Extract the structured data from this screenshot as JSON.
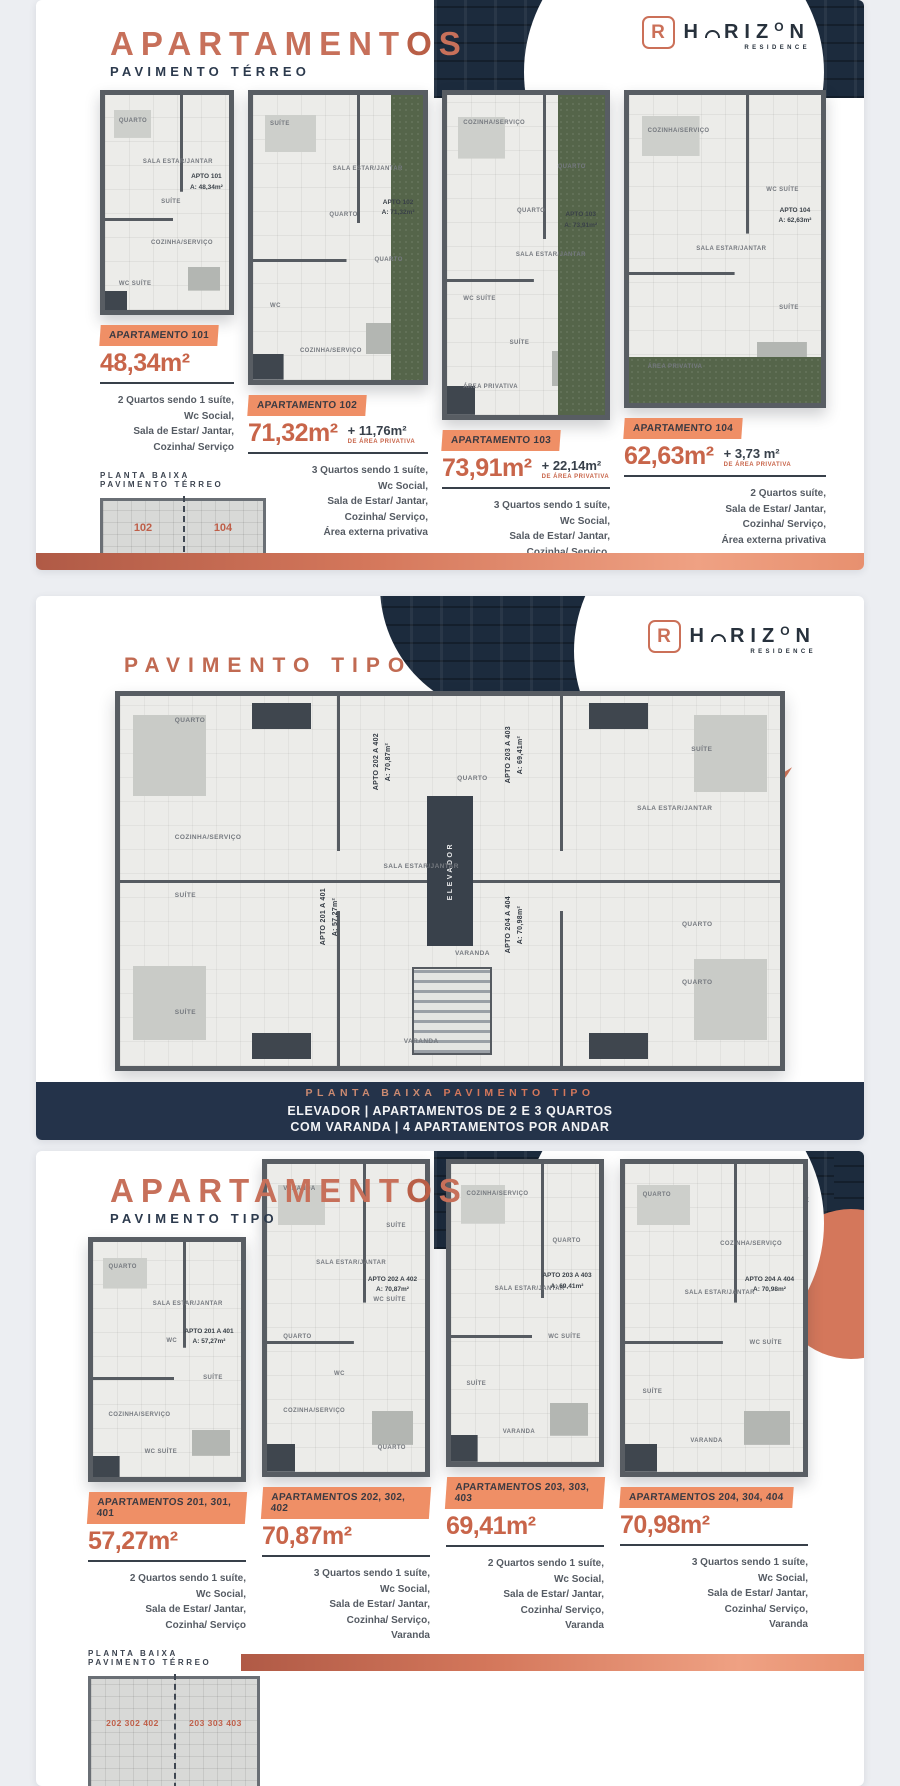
{
  "brand": {
    "logo_mark": "R",
    "logo_h": "H",
    "logo_riz": "RIZ",
    "logo_o": "O",
    "logo_n": "N",
    "logo_sub": "RESIDENCE",
    "accent": "#c7705a",
    "navy": "#24334a",
    "badge": "#ef8f66"
  },
  "terreo": {
    "title_a": "APARTAMENT",
    "title_b": "O",
    "title_c": "S",
    "subtitle": "PAVIMENTO TÉRREO",
    "apartments": [
      {
        "badge": "APARTAMENTO 101",
        "area": "48,34m²",
        "extra": "",
        "extra_note": "",
        "plan_tag": "APTO 101\nA: 48,34m²",
        "rooms": [
          "QUARTO",
          "SALA ESTAR/JANTAR",
          "SUÍTE",
          "COZINHA/SERVIÇO",
          "WC SUÍTE"
        ],
        "features": "2 Quartos sendo 1 suíte,\nWc Social,\nSala de Estar/ Jantar,\nCozinha/ Serviço"
      },
      {
        "badge": "APARTAMENTO 102",
        "area": "71,32m²",
        "extra": "+ 11,76m²",
        "extra_note": "DE ÁREA PRIVATIVA",
        "plan_tag": "APTO 102\nA: 71,32m²",
        "rooms": [
          "SUÍTE",
          "SALA ESTAR/JANTAR",
          "QUARTO",
          "QUARTO",
          "WC",
          "COZINHA/SERVIÇO"
        ],
        "features": "3 Quartos sendo 1 suíte,\nWc Social,\nSala de Estar/ Jantar,\nCozinha/ Serviço,\nÁrea externa privativa"
      },
      {
        "badge": "APARTAMENTO 103",
        "area": "73,91m²",
        "extra": "+ 22,14m²",
        "extra_note": "DE ÁREA PRIVATIVA",
        "plan_tag": "APTO 103\nA: 73,91m²",
        "rooms": [
          "COZINHA/SERVIÇO",
          "QUARTO",
          "QUARTO",
          "SALA ESTAR/JANTAR",
          "WC SUÍTE",
          "SUÍTE",
          "ÁREA PRIVATIVA"
        ],
        "features": "3 Quartos sendo 1 suíte,\nWc Social,\nSala de Estar/ Jantar,\nCozinha/ Serviço,\nÁrea externa privativa"
      },
      {
        "badge": "APARTAMENTO 104",
        "area": "62,63m²",
        "extra": "+ 3,73 m²",
        "extra_note": "DE ÁREA PRIVATIVA",
        "plan_tag": "APTO 104\nA: 62,63m²",
        "rooms": [
          "COZINHA/SERVIÇO",
          "WC SUÍTE",
          "SALA ESTAR/JANTAR",
          "SUÍTE",
          "ÁREA PRIVATIVA"
        ],
        "features": "2 Quartos suíte,\nSala de Estar/ Jantar,\nCozinha/ Serviço,\nÁrea externa privativa"
      }
    ],
    "miniplan_title": "PLANTA BAIXA PAVIMENTO TÉRREO",
    "miniplan_units": [
      "102",
      "104",
      "101",
      "103"
    ]
  },
  "tipo_plan": {
    "title_a": "PAVIMENTO ",
    "title_b": "TIPO",
    "units": [
      "APTO 201 A 401\nA: 57,27m²",
      "APTO 202 A 402\nA: 70,87m²",
      "APTO 203 A 403\nA: 69,41m²",
      "APTO 204 A 404\nA: 70,98m²"
    ],
    "elevator": "ELEVADOR",
    "rooms": [
      "QUARTO",
      "SUÍTE",
      "QUARTO",
      "SALA ESTAR/JANTAR",
      "COZINHA/SERVIÇO",
      "SALA ESTAR/JANTAR",
      "SUÍTE",
      "QUARTO",
      "VARANDA",
      "QUARTO",
      "SUÍTE",
      "VARANDA"
    ],
    "band_a": "PLANTA BAIXA ",
    "band_b": "PAVIMENTO TIPO",
    "band_line2": "ELEVADOR | APARTAMENTOS DE 2 E 3 QUARTOS",
    "band_line3": "COM VARANDA | 4 APARTAMENTOS POR ANDAR"
  },
  "tipo_apts": {
    "title_a": "APARTAMENT",
    "title_b": "O",
    "title_c": "S",
    "subtitle": "PAVIMENTO TIPO",
    "apartments": [
      {
        "badge": "APARTAMENTOS 201, 301, 401",
        "area": "57,27m²",
        "extra": "",
        "extra_note": "",
        "plan_tag": "APTO 201 A 401\nA: 57,27m²",
        "rooms": [
          "QUARTO",
          "SALA ESTAR/JANTAR",
          "WC",
          "SUÍTE",
          "COZINHA/SERVIÇO",
          "WC SUÍTE"
        ],
        "features": "2 Quartos sendo 1 suíte,\nWc Social,\nSala de Estar/ Jantar,\nCozinha/ Serviço"
      },
      {
        "badge": "APARTAMENTOS 202, 302, 402",
        "area": "70,87m²",
        "extra": "",
        "extra_note": "",
        "plan_tag": "APTO 202 A 402\nA: 70,87m²",
        "rooms": [
          "VARANDA",
          "SUÍTE",
          "SALA ESTAR/JANTAR",
          "WC SUÍTE",
          "QUARTO",
          "WC",
          "COZINHA/SERVIÇO",
          "QUARTO"
        ],
        "features": "3 Quartos sendo 1 suíte,\nWc Social,\nSala de Estar/ Jantar,\nCozinha/ Serviço,\nVaranda"
      },
      {
        "badge": "APARTAMENTOS 203, 303, 403",
        "area": "69,41m²",
        "extra": "",
        "extra_note": "",
        "plan_tag": "APTO 203 A 403\nA: 69,41m²",
        "rooms": [
          "COZINHA/SERVIÇO",
          "QUARTO",
          "SALA ESTAR/JANTAR",
          "WC SUÍTE",
          "SUÍTE",
          "VARANDA"
        ],
        "features": "2 Quartos sendo 1 suíte,\nWc Social,\nSala de Estar/ Jantar,\nCozinha/ Serviço,\nVaranda"
      },
      {
        "badge": "APARTAMENTOS 204, 304, 404",
        "area": "70,98m²",
        "extra": "",
        "extra_note": "",
        "plan_tag": "APTO 204 A 404\nA: 70,98m²",
        "rooms": [
          "QUARTO",
          "COZINHA/SERVIÇO",
          "SALA ESTAR/JANTAR",
          "WC SUÍTE",
          "SUÍTE",
          "VARANDA"
        ],
        "features": "3 Quartos sendo 1 suíte,\nWc Social,\nSala de Estar/ Jantar,\nCozinha/ Serviço,\nVaranda"
      }
    ],
    "miniplan_title": "PLANTA BAIXA PAVIMENTO TÉRREO",
    "miniplan_units": [
      "202 302 402",
      "203 303 403",
      "201 301 401",
      "204 304 404"
    ]
  }
}
